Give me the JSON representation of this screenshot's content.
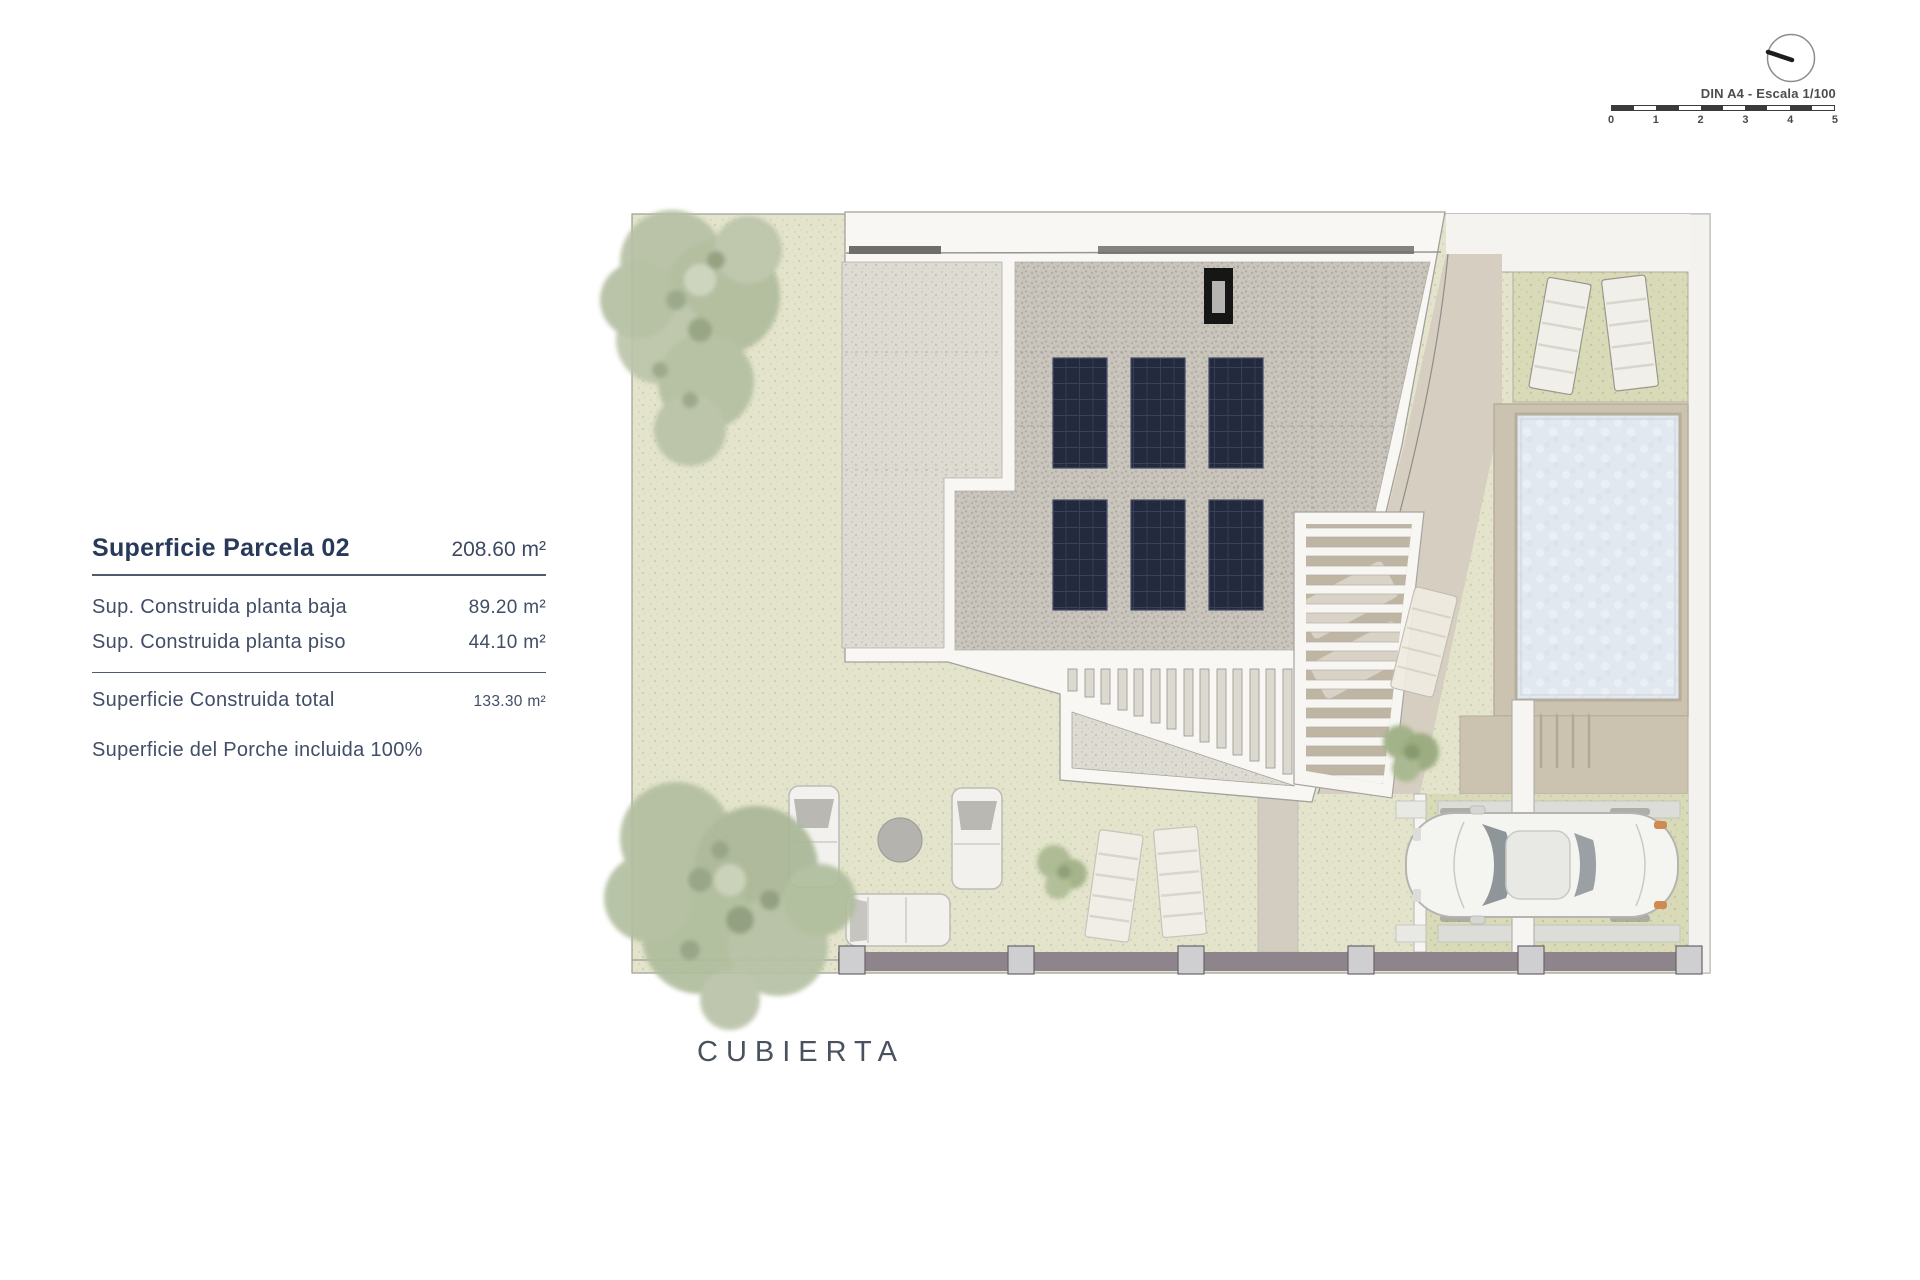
{
  "info_panel": {
    "title": {
      "label": "Superficie Parcela 02",
      "value": "208.60 m²"
    },
    "rows": [
      {
        "label": "Sup. Construida planta baja",
        "value": "89.20 m²"
      },
      {
        "label": "Sup. Construida planta piso",
        "value": "44.10 m²"
      }
    ],
    "total": {
      "label": "Superficie Construida total",
      "value": "133.30 m²"
    },
    "note": "Superficie del Porche incluida 100%"
  },
  "plan_label": "CUBIERTA",
  "scale_block": {
    "din_label": "DIN A4 - Escala 1/100",
    "ticks": [
      "0",
      "1",
      "2",
      "3",
      "4",
      "5"
    ]
  },
  "colors": {
    "text_navy": "#28395a",
    "grass": "#e3e4cb",
    "grass_dark": "#d9dab7",
    "gravel_light": "#dedbd3",
    "gravel_dark": "#c9c5bc",
    "solar_panel": "#232a3d",
    "pool_water": "#e1e8ef",
    "deck_tan": "#ccc2b0",
    "path_beige": "#d6cec0",
    "fence": "#8d858b",
    "tree_green": "#b5c0a2"
  }
}
